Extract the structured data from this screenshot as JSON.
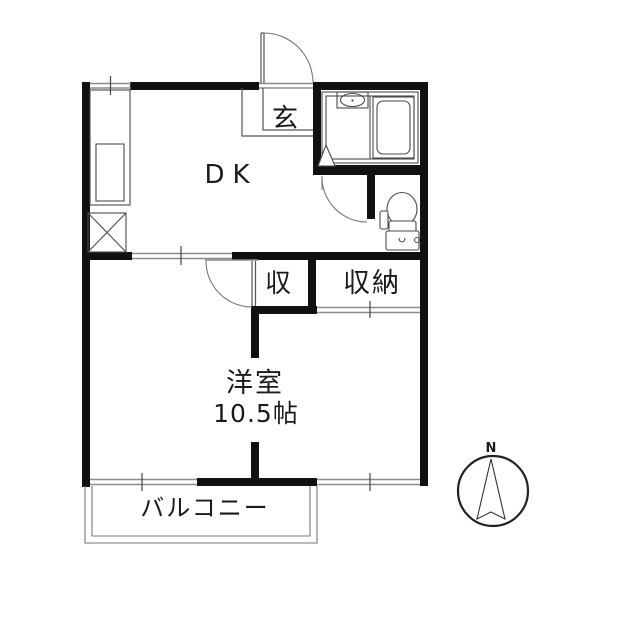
{
  "rooms": {
    "entrance": "玄",
    "dining_kitchen": "DK",
    "storage_small": "収",
    "storage_closet": "収納",
    "western_room_name": "洋室",
    "western_room_size": "10.5帖",
    "balcony": "バルコニー"
  },
  "compass": {
    "north_label": "N"
  },
  "colors": {
    "wall": "#111111",
    "thin_line": "#555555",
    "light_line": "#8a8a8a",
    "background": "#ffffff",
    "text": "#1a1a1a"
  }
}
